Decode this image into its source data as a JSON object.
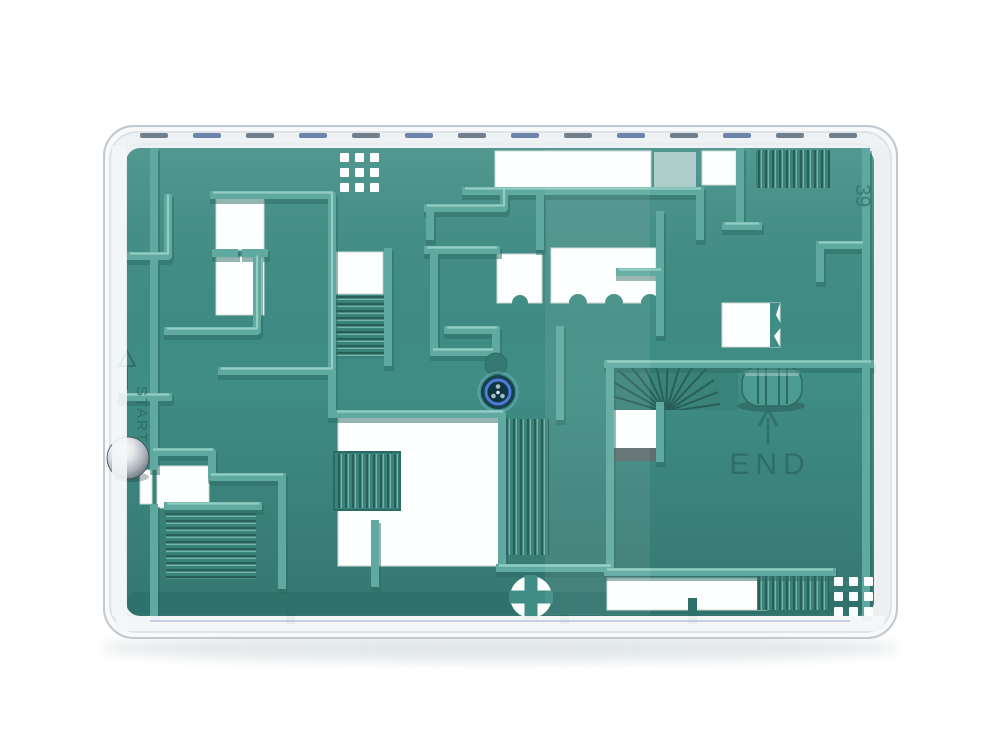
{
  "scene": {
    "type": "product-photo",
    "subject": "Teal plastic ball-in-maze puzzle inside a clear rounded rectangular case, steel ball at the START corridor on the left, END room on the right",
    "background": "white"
  },
  "labels": {
    "start": "START",
    "end": "END",
    "mold_number": "39"
  },
  "colors": {
    "background": "#ffffff",
    "case-shell": "#f7f9fa",
    "case-inner": "#eef2f4",
    "case-edge": "#c3cacf",
    "case-edge-soft": "#dde3e6",
    "rim": "#f3f6f8",
    "floor": "#3f8d85",
    "floor-deep": "#2e716a",
    "wall": "#5fa9a0",
    "wall-top": "#98d2c7",
    "wall-shadow": "#2c6b63",
    "stair-base": "#3a837b",
    "stair-groove": "#275f58",
    "stair-ridge": "#79bcb2",
    "hole": "#fdfefe",
    "hole-edge": "#cfd9d7",
    "step-gray": "#5f6d6e",
    "vent-dash": "#5b6a78",
    "vent-dash-blue": "#56719e",
    "emboss": "#2c6a63",
    "screw-ring-blue": "#4d7bdc",
    "screw-body": "#16424c",
    "ball-shadow": "rgba(30,40,45,0.28)",
    "bottom-blue-line": "#8ea4cd"
  }
}
